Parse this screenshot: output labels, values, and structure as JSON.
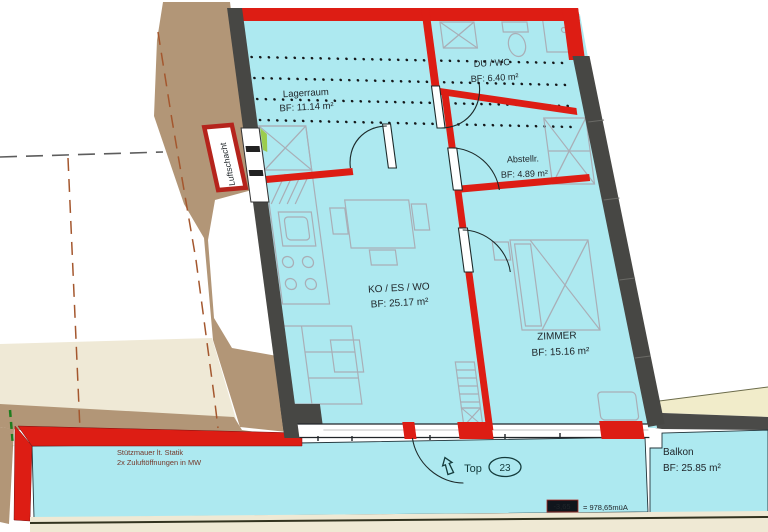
{
  "plan": {
    "rooms": {
      "lagerraum": {
        "name": "Lagerraum",
        "area": "BF: 11.14 m²"
      },
      "du_wc": {
        "name": "DU / WC",
        "area": "BF: 6.40 m²"
      },
      "abstellraum": {
        "name": "Abstellr.",
        "area": "BF: 4.89 m²"
      },
      "kueche_essen_wohnen": {
        "name": "KO / ES / WO",
        "area": "BF: 25.17 m²"
      },
      "zimmer": {
        "name": "ZIMMER",
        "area": "BF: 15.16 m²"
      },
      "balkon": {
        "name": "Balkon",
        "area": "BF: 25.85 m²"
      }
    },
    "labels": {
      "luftschacht": "Luftschacht",
      "unit_prefix": "Top",
      "unit_number": "23",
      "note_line1": "Stützmauer lt. Statik",
      "note_line2": "2x Zuluftöffnungen in MW",
      "level_value": "-3,65",
      "level_reference": "= 978,65müA"
    },
    "colors": {
      "floor_cyan": "#ade9f0",
      "wall_gray": "#474744",
      "wall_red": "#dd1d14",
      "terrain_tan": "#b29677",
      "terrain_cream": "#efe9d6",
      "wedge_yellow": "#f1ecca",
      "furniture_gray": "#a9aeb6"
    }
  }
}
